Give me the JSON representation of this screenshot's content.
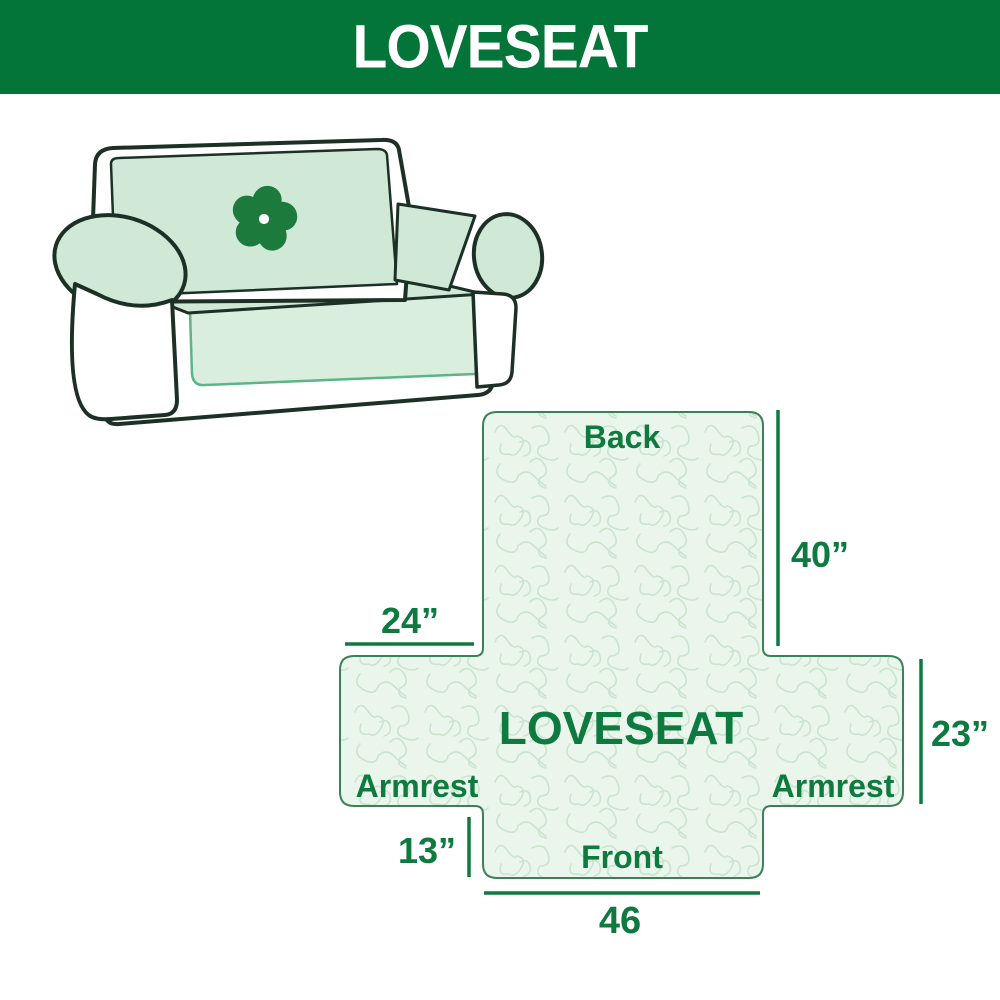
{
  "header": {
    "title": "LOVESEAT"
  },
  "illustration": {
    "alt": "loveseat sofa with quilted protective cover",
    "logo_icon": "pinwheel-flower-icon"
  },
  "diagram": {
    "center_label": "LOVESEAT",
    "back_label": "Back",
    "front_label": "Front",
    "armrest_left_label": "Armrest",
    "armrest_right_label": "Armrest",
    "dim_back_height": "40”",
    "dim_armrest_width": "24”",
    "dim_armrest_height": "23”",
    "dim_front_height": "13”",
    "dim_front_width": "46"
  },
  "colors": {
    "header_bg": "#047539",
    "header_text": "#ffffff",
    "label_green": "#0e7a40",
    "cover_mint": "#cfe9d6",
    "cover_mint_light": "#d9eedd",
    "sofa_outline": "#1c3026",
    "skirt_outline": "#5cb585",
    "diagram_fill": "#eaf6ec",
    "diagram_pattern": "#cbe4cd",
    "diagram_border": "#3a8159",
    "logo_green": "#1b7a3c"
  }
}
